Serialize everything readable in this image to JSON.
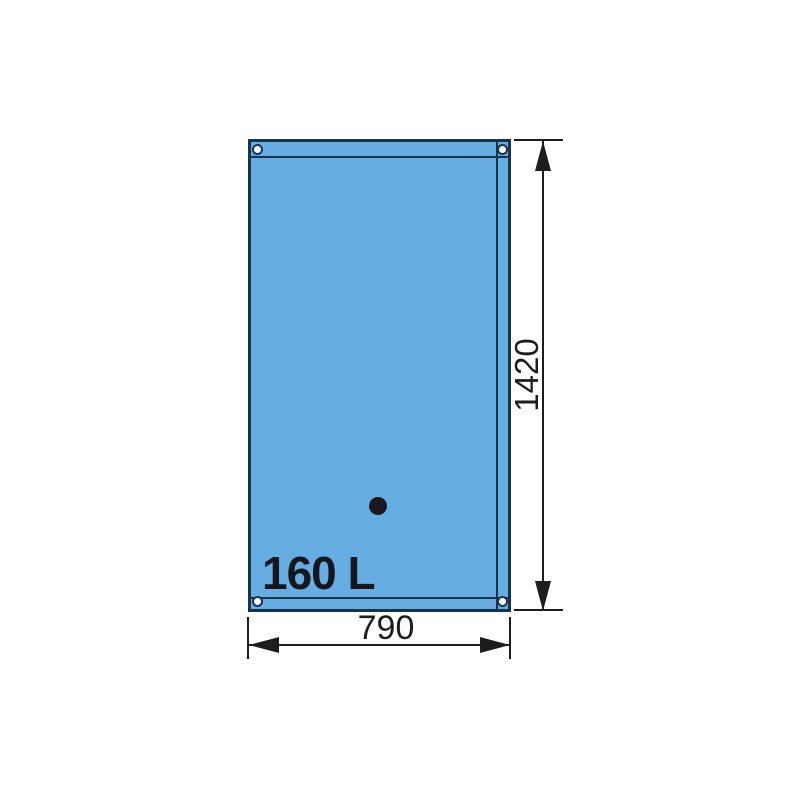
{
  "tank": {
    "capacity_label": "160 L"
  },
  "dimensions": {
    "height_mm": "1420",
    "width_mm": "790"
  },
  "colors": {
    "tank_fill": "#66ade2",
    "tank_outline": "#17344c",
    "dimension_lines": "#1d1d1d",
    "capacity_text": "#15161e",
    "background": "#ffffff"
  },
  "shapes": {
    "corner_eyelet": "ring-circle",
    "filler_cap": "filled-circle"
  }
}
